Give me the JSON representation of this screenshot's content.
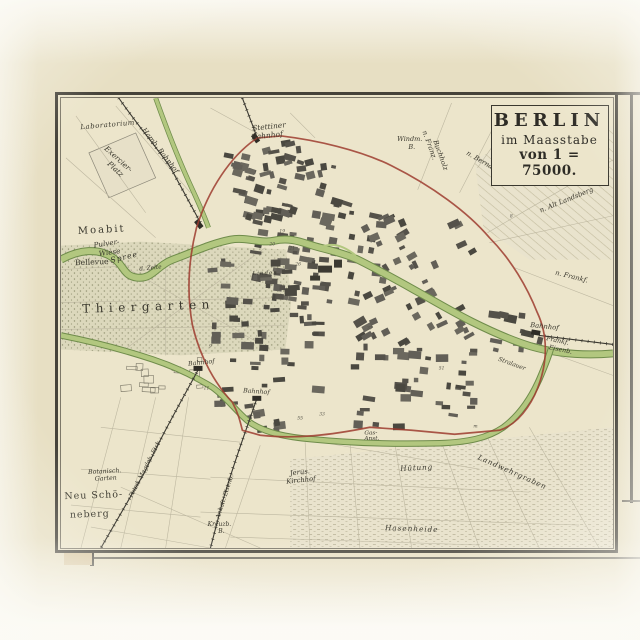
{
  "map": {
    "title_cartouche": {
      "line1": "BERLIN",
      "line2": "im Maasstabe",
      "line3": "von 1 = 75000."
    },
    "colors": {
      "paper": "#e7dfc3",
      "map_paper": "#ece5cb",
      "frame": "#46433a",
      "water_fill": "#b2c77f",
      "water_edge": "#6f8c4b",
      "customs_wall_red": "#9d3c2f",
      "block_dark": "#54514a",
      "ink": "#3a382e",
      "park": "#dcd8bc"
    },
    "labels": [
      {
        "id": "laboratorium",
        "text": "Laboratorium",
        "x": 47,
        "y": 29,
        "r": -5,
        "s": 7,
        "italic": true,
        "sp": 0.5
      },
      {
        "id": "exercier",
        "text": "Exercier-",
        "x": 56,
        "y": 63,
        "r": 42,
        "s": 7.5,
        "italic": true
      },
      {
        "id": "platz",
        "text": "Platz",
        "x": 53,
        "y": 73,
        "r": 42,
        "s": 7.5,
        "italic": true
      },
      {
        "id": "hamb-bahnhof",
        "text": "Hamb. Bahnhof",
        "x": 98,
        "y": 54,
        "r": 52,
        "s": 7,
        "italic": true
      },
      {
        "id": "stettiner",
        "text": "Stettiner",
        "x": 209,
        "y": 31,
        "r": -6,
        "s": 7.5,
        "italic": true
      },
      {
        "id": "stettiner-bahnhof",
        "text": "Bahnhof",
        "x": 207,
        "y": 40,
        "r": -6,
        "s": 7.5,
        "italic": true
      },
      {
        "id": "windm",
        "text": "Windm.",
        "x": 350,
        "y": 43,
        "r": 0,
        "s": 6.5,
        "italic": true
      },
      {
        "id": "windm-b",
        "text": "B.",
        "x": 352,
        "y": 51,
        "r": 0,
        "s": 6.5,
        "italic": true
      },
      {
        "id": "n-franz",
        "text": "n. Franz.",
        "x": 368,
        "y": 48,
        "r": 70,
        "s": 6.8,
        "italic": true
      },
      {
        "id": "buchholz",
        "text": "Buchholz",
        "x": 379,
        "y": 58,
        "r": 70,
        "s": 6.8,
        "italic": true
      },
      {
        "id": "n-bernau",
        "text": "n. Bernau",
        "x": 421,
        "y": 65,
        "r": 30,
        "s": 6.8,
        "italic": true
      },
      {
        "id": "friedrichshain",
        "text": "Friedrichshain",
        "x": 490,
        "y": 80,
        "r": -4,
        "s": 8.5,
        "italic": true,
        "sp": 1
      },
      {
        "id": "n-alt-landsberg",
        "text": "n. Alt Landsberg",
        "x": 508,
        "y": 104,
        "r": -22,
        "s": 6.8,
        "italic": true
      },
      {
        "id": "moabit",
        "text": "Moabit",
        "x": 41,
        "y": 135,
        "r": -3,
        "s": 10,
        "sp": 2
      },
      {
        "id": "pulver",
        "text": "Pulver-",
        "x": 46,
        "y": 148,
        "r": -8,
        "s": 7.2,
        "italic": true
      },
      {
        "id": "wiese",
        "text": "Wiese",
        "x": 49,
        "y": 157,
        "r": -8,
        "s": 7.2,
        "italic": true
      },
      {
        "id": "bellevue",
        "text": "Bellevue",
        "x": 31,
        "y": 167,
        "r": -2,
        "s": 7.8
      },
      {
        "id": "spree",
        "text": "Spree",
        "x": 64,
        "y": 162,
        "r": -14,
        "s": 7.8,
        "italic": true,
        "sp": 1
      },
      {
        "id": "zelte",
        "text": "d. Zelte",
        "x": 90,
        "y": 172,
        "r": -6,
        "s": 5.8,
        "italic": true
      },
      {
        "id": "thiergarten",
        "text": "Thiergarten",
        "x": 88,
        "y": 213,
        "r": -2,
        "s": 12,
        "sp": 5.5
      },
      {
        "id": "linden",
        "text": "Linden",
        "x": 205,
        "y": 177,
        "r": -2,
        "s": 5.5,
        "italic": true,
        "sp": 1
      },
      {
        "id": "bahnhof-potsdamer",
        "text": "Bahnhof",
        "x": 141,
        "y": 267,
        "r": -6,
        "s": 6.3,
        "italic": true
      },
      {
        "id": "bahnhof-anhalter",
        "text": "Bahnhof",
        "x": 196,
        "y": 296,
        "r": 4,
        "s": 6.3,
        "italic": true
      },
      {
        "id": "gas",
        "text": "Gas-",
        "x": 311,
        "y": 337,
        "r": 0,
        "s": 5.8,
        "italic": true
      },
      {
        "id": "anst",
        "text": "Anst.",
        "x": 312,
        "y": 343,
        "r": 0,
        "s": 5.8,
        "italic": true
      },
      {
        "id": "bahnhof-frankfurter",
        "text": "Bahnhof",
        "x": 485,
        "y": 231,
        "r": 6,
        "s": 6.8,
        "italic": true
      },
      {
        "id": "frankf",
        "text": "Frankf.",
        "x": 498,
        "y": 245,
        "r": 12,
        "s": 6.3,
        "italic": true
      },
      {
        "id": "eisenb",
        "text": "Eisenb.",
        "x": 501,
        "y": 254,
        "r": 12,
        "s": 6.3,
        "italic": true
      },
      {
        "id": "n-frankf",
        "text": "n. Frankf.",
        "x": 512,
        "y": 181,
        "r": 14,
        "s": 6.8,
        "italic": true
      },
      {
        "id": "stralauer",
        "text": "Stralauer",
        "x": 452,
        "y": 268,
        "r": 20,
        "s": 6,
        "italic": true
      },
      {
        "id": "landwehrgraben",
        "text": "Landwehrgraben",
        "x": 452,
        "y": 377,
        "r": 24,
        "s": 7.3,
        "italic": true,
        "sp": 0.8
      },
      {
        "id": "huetung",
        "text": "Hütung",
        "x": 357,
        "y": 373,
        "r": -3,
        "s": 7.3,
        "italic": true,
        "sp": 0.8
      },
      {
        "id": "jerus",
        "text": "Jerus.",
        "x": 240,
        "y": 377,
        "r": -6,
        "s": 6.8,
        "italic": true
      },
      {
        "id": "kirchhof",
        "text": "Kirchhof",
        "x": 241,
        "y": 385,
        "r": -6,
        "s": 6.8,
        "italic": true
      },
      {
        "id": "hasenheide",
        "text": "Hasenheide",
        "x": 352,
        "y": 434,
        "r": 2,
        "s": 7.3,
        "italic": true,
        "sp": 1
      },
      {
        "id": "botanisch",
        "text": "Botanisch.",
        "x": 44,
        "y": 376,
        "r": -3,
        "s": 6.3,
        "italic": true
      },
      {
        "id": "garten",
        "text": "Garten",
        "x": 45,
        "y": 383,
        "r": -3,
        "s": 6.3,
        "italic": true
      },
      {
        "id": "neu-schoe",
        "text": "Neu Schö-",
        "x": 33,
        "y": 401,
        "r": -2,
        "s": 9.5,
        "sp": 1
      },
      {
        "id": "neberg",
        "text": "neberg",
        "x": 29,
        "y": 420,
        "r": -2,
        "s": 9.5,
        "sp": 1
      },
      {
        "id": "kreuzb",
        "text": "Kreuzb.",
        "x": 159,
        "y": 429,
        "r": 0,
        "s": 6,
        "italic": true
      },
      {
        "id": "kreuzb-b",
        "text": "B.",
        "x": 161,
        "y": 436,
        "r": 0,
        "s": 6,
        "italic": true
      },
      {
        "id": "potsd-magdeb-eisenb",
        "text": "Potsd. Magdeb. Eisb.",
        "x": 86,
        "y": 372,
        "r": -63,
        "s": 6,
        "italic": true
      },
      {
        "id": "anhalt-eisenb",
        "text": "Anhalt. Eisenb.",
        "x": 166,
        "y": 400,
        "r": -72,
        "s": 6,
        "italic": true
      }
    ],
    "numerals": [
      {
        "text": "19",
        "x": 222,
        "y": 135
      },
      {
        "text": "20",
        "x": 212,
        "y": 148
      },
      {
        "text": "21",
        "x": 232,
        "y": 152
      },
      {
        "text": "26",
        "x": 238,
        "y": 168
      },
      {
        "text": "7",
        "x": 120,
        "y": 212
      },
      {
        "text": "11",
        "x": 146,
        "y": 292
      },
      {
        "text": "37",
        "x": 310,
        "y": 232
      },
      {
        "text": "51",
        "x": 382,
        "y": 272
      },
      {
        "text": "55",
        "x": 240,
        "y": 322
      },
      {
        "text": "33",
        "x": 262,
        "y": 318
      },
      {
        "text": "8",
        "x": 452,
        "y": 120
      },
      {
        "text": "9",
        "x": 150,
        "y": 250
      },
      {
        "text": "m",
        "x": 416,
        "y": 330
      }
    ]
  }
}
